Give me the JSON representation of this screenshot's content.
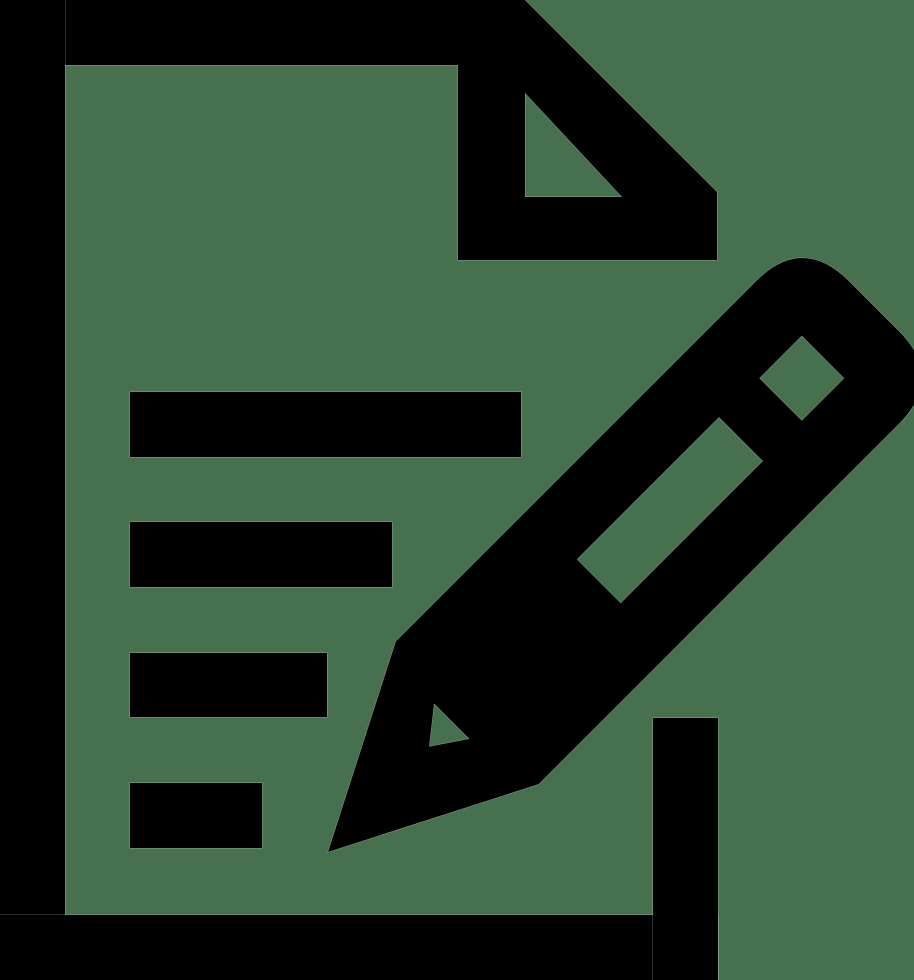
{
  "colors": {
    "background": "#47714e",
    "icon": "#000000",
    "edge_fringe": "rgba(255,255,255,0.45)"
  },
  "icon": {
    "name": "document-edit",
    "description": "Black glyph icon of a document with a folded top-right corner and four text lines, overlaid by a large pencil writing diagonally across the page",
    "parts": [
      {
        "label": "document-frame"
      },
      {
        "label": "folded-corner-flap"
      },
      {
        "label": "text-line-1"
      },
      {
        "label": "text-line-2"
      },
      {
        "label": "text-line-3"
      },
      {
        "label": "text-line-4"
      },
      {
        "label": "pencil-with-eraser-cap-and-nib"
      }
    ]
  }
}
